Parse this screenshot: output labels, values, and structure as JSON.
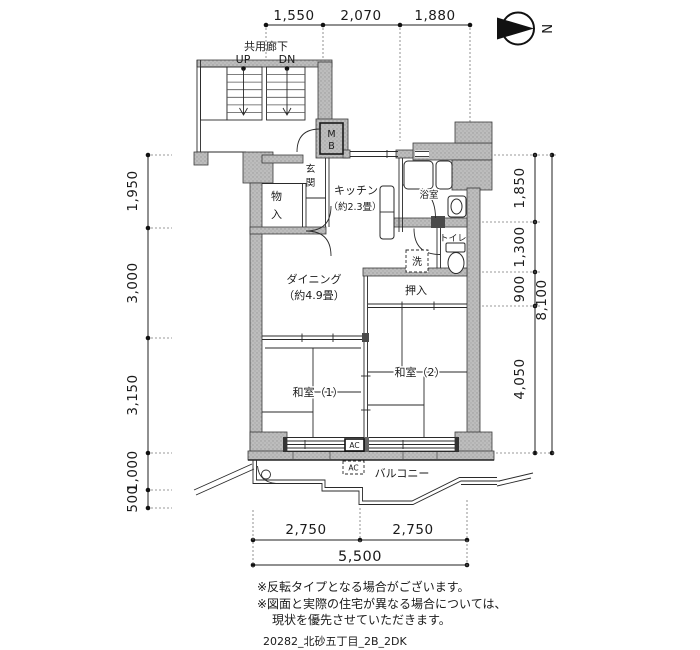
{
  "compass": {
    "north": "N"
  },
  "dimensions": {
    "top": [
      "1,550",
      "2,070",
      "1,880"
    ],
    "left": [
      "1,950",
      "3,000",
      "3,150",
      "1,000",
      "500"
    ],
    "right": [
      "1,850",
      "1,300",
      "900",
      "4,050"
    ],
    "right_total": "8,100",
    "bottom": [
      "2,750",
      "2,750"
    ],
    "bottom_total": "5,500"
  },
  "common_area": {
    "corridor": "共用廊下",
    "up": "UP",
    "down": "DN",
    "meter_box": [
      "M",
      "B"
    ]
  },
  "rooms": {
    "entrance": [
      "玄",
      "関"
    ],
    "storage": [
      "物",
      "入"
    ],
    "kitchen_line1": "キッチン",
    "kitchen_line2": "（約2.3畳）",
    "bath": "浴室",
    "toilet": "トイレ",
    "washer": "洗",
    "dining_line1": "ダイニング",
    "dining_line2": "（約4.9畳）",
    "closet": "押入",
    "japanese_room1": "和室（1）",
    "japanese_room2": "和室（2）",
    "balcony": "バルコニー",
    "ac_unit": "AC",
    "ac_outdoor": "AC"
  },
  "notes": [
    "※反転タイプとなる場合がございます。",
    "※図面と実際の住宅が異なる場合については、",
    "現状を優先させていただきます。"
  ],
  "plan_id": "20282_北砂五丁目_2B_2DK",
  "colors": {
    "wall_fill": "#b9b9b9",
    "line": "#1a1a1a",
    "bg": "#ffffff"
  }
}
